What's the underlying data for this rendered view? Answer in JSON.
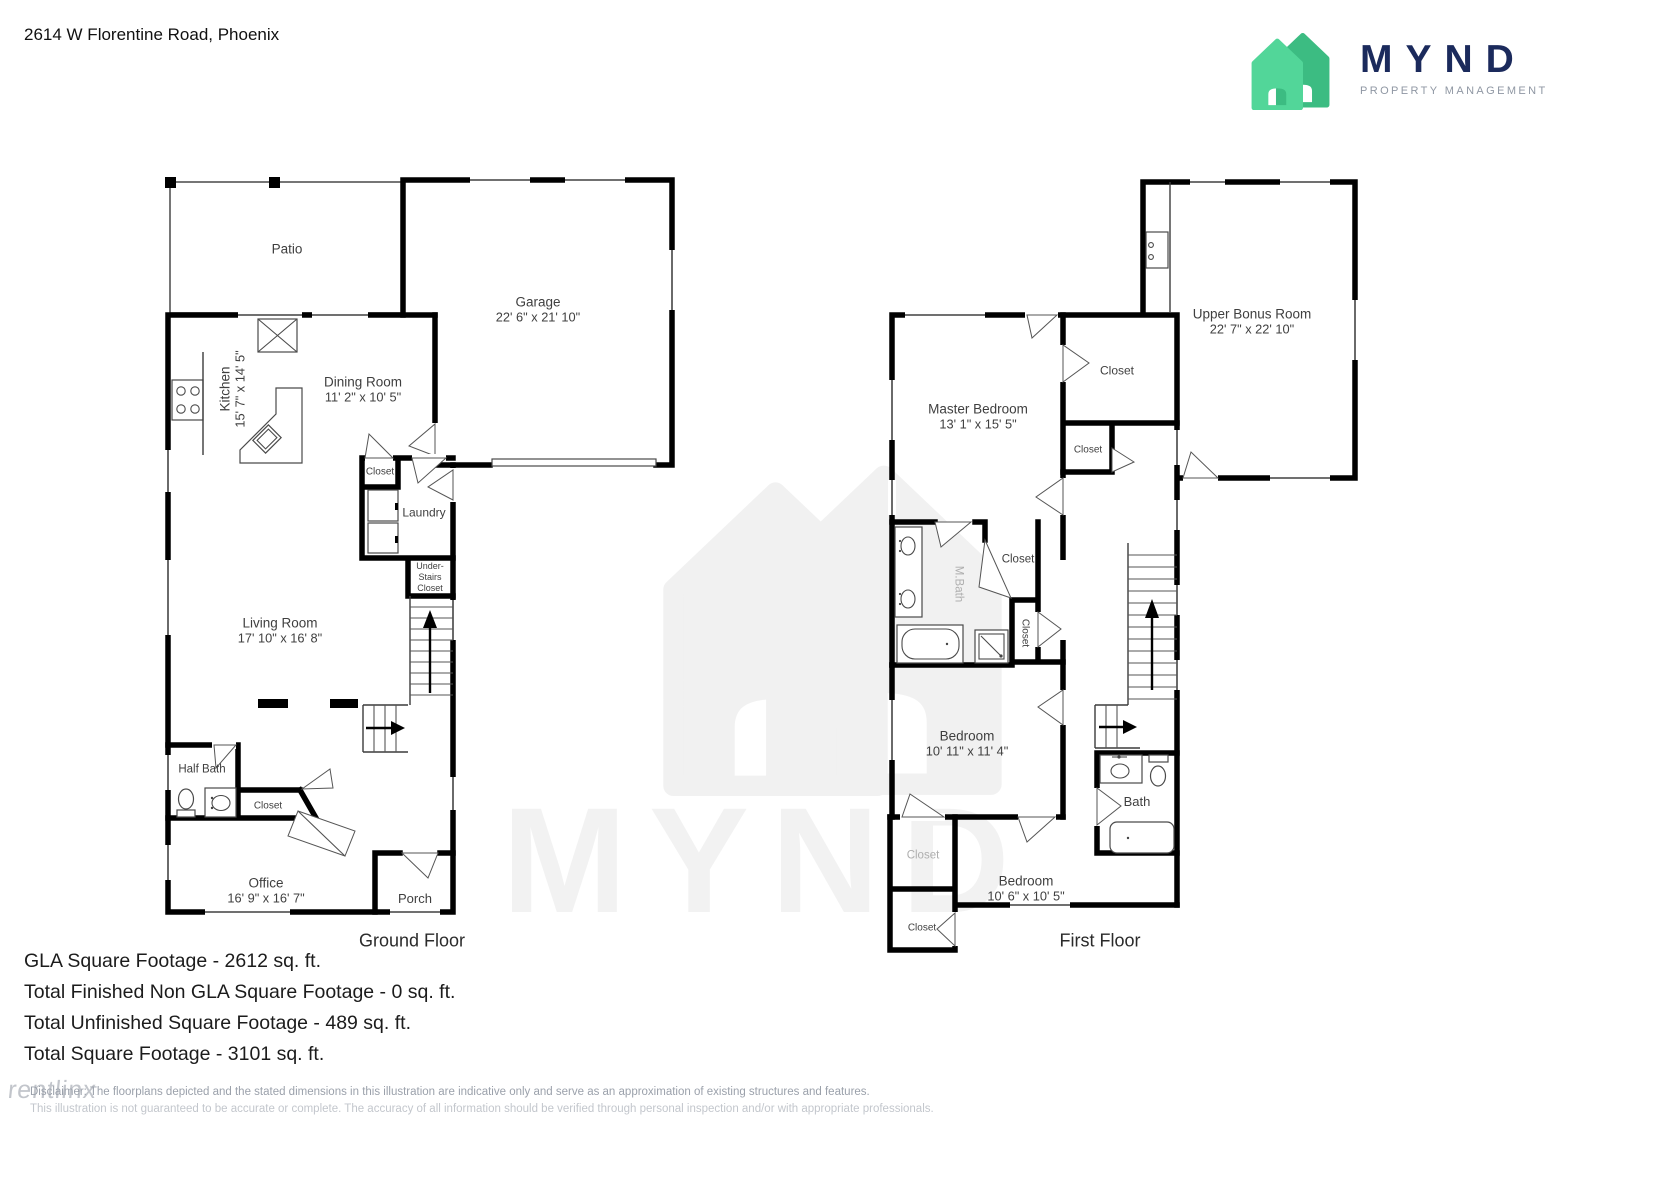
{
  "header": {
    "address": "2614 W Florentine Road, Phoenix"
  },
  "logo": {
    "wordmark": "MYND",
    "subtitle": "PROPERTY MANAGEMENT",
    "brand_navy": "#1b2a5c",
    "brand_green_light": "#52d699",
    "brand_green_dark": "#3cbc82"
  },
  "floors": [
    {
      "caption": "Ground Floor",
      "rooms": [
        {
          "name": "Patio"
        },
        {
          "name": "Garage",
          "dims": "22' 6\" x 21' 10\""
        },
        {
          "name": "Kitchen",
          "dims": "15' 7\" x 14' 5\""
        },
        {
          "name": "Dining Room",
          "dims": "11' 2\" x 10' 5\""
        },
        {
          "name": "Closet"
        },
        {
          "name": "Laundry"
        },
        {
          "name": "Under-\nStairs\nCloset"
        },
        {
          "name": "Living Room",
          "dims": "17' 10\" x 16' 8\""
        },
        {
          "name": "Half Bath"
        },
        {
          "name": "Closet"
        },
        {
          "name": "Office",
          "dims": "16' 9\" x 16' 7\""
        },
        {
          "name": "Porch"
        }
      ]
    },
    {
      "caption": "First Floor",
      "rooms": [
        {
          "name": "Master Bedroom",
          "dims": "13' 1\" x 15' 5\""
        },
        {
          "name": "Closet"
        },
        {
          "name": "Closet"
        },
        {
          "name": "Upper Bonus Room",
          "dims": "22' 7\" x 22' 10\""
        },
        {
          "name": "Closet"
        },
        {
          "name": "Closet"
        },
        {
          "name": "M.Bath"
        },
        {
          "name": "Bedroom",
          "dims": "10' 11\" x 11' 4\""
        },
        {
          "name": "Closet"
        },
        {
          "name": "Bedroom",
          "dims": "10' 6\" x 10' 5\""
        },
        {
          "name": "Closet"
        },
        {
          "name": "Bath"
        }
      ]
    }
  ],
  "footer": {
    "lines": [
      "GLA Square Footage - 2612 sq. ft.",
      "Total Finished Non GLA Square Footage - 0 sq. ft.",
      "Total Unfinished Square Footage - 489 sq. ft.",
      "Total Square Footage - 3101 sq. ft."
    ],
    "disclaimer_line1": "Disclaimer: The floorplans depicted and the stated dimensions in this illustration are indicative only and serve as an approximation of existing structures and features.",
    "disclaimer_line2": "This illustration is not guaranteed to be accurate or complete. The accuracy of all information should be verified through personal inspection and/or with appropriate professionals.",
    "vendor_watermark": "rentlinx"
  },
  "watermark": {
    "wordmark": "MYND"
  }
}
